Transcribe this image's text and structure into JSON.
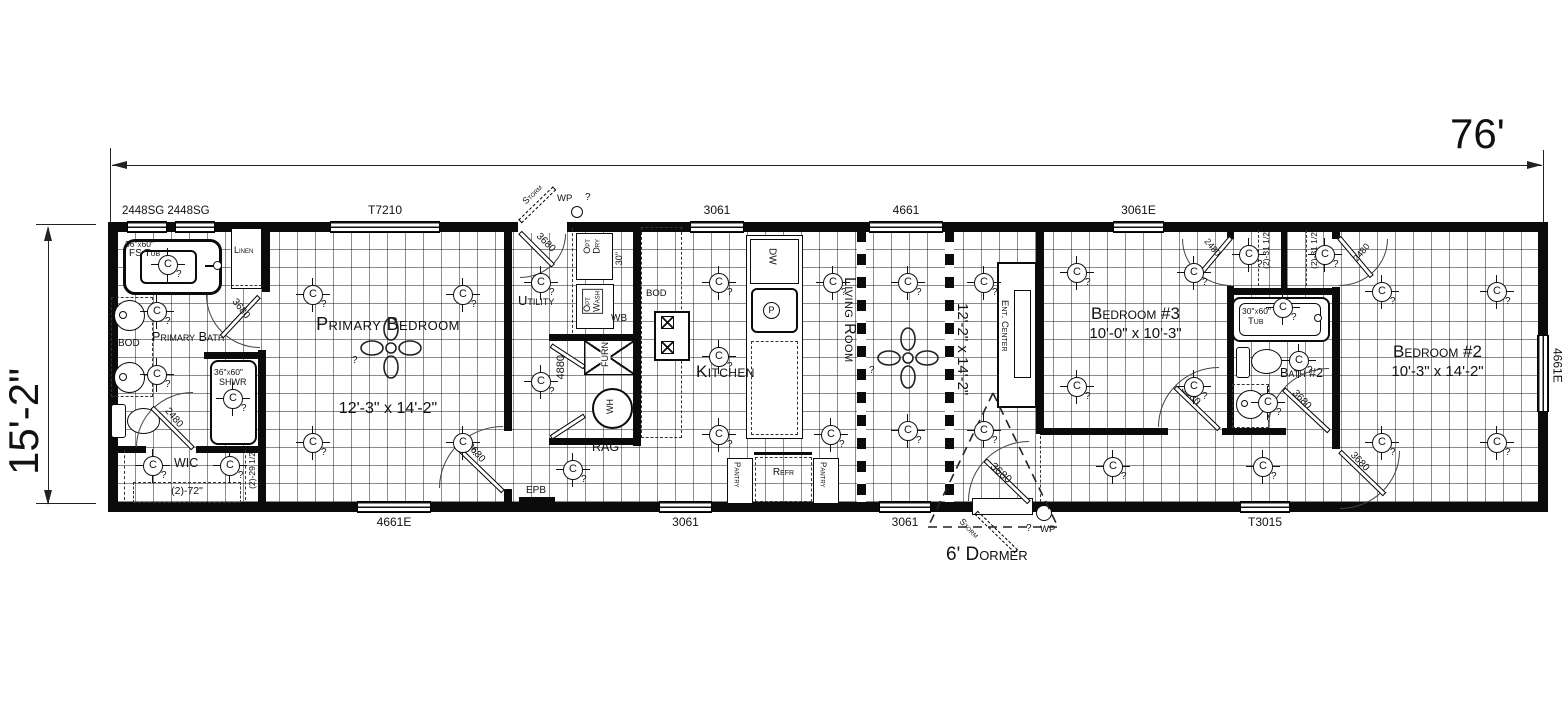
{
  "dimension_labels": {
    "overall_width": "76'",
    "overall_height": "15'-2\""
  },
  "window_labels": {
    "pair_2448sg": "2448SG 2448SG",
    "t7210": "T7210",
    "top_3061": "3061",
    "top_4661": "4661",
    "top_3061e": "3061E",
    "bottom_4661e": "4661E",
    "bottom_3061_kitchen": "3061",
    "bottom_3061_living": "3061",
    "bottom_t3015": "T3015",
    "right_4661e": "4661E"
  },
  "door_labels": {
    "d3680": "3680",
    "d2480": "2480",
    "d4880": "4880"
  },
  "rooms": {
    "primary_bath": {
      "name": "Primary Bath"
    },
    "wic": {
      "name": "WIC",
      "side_shelf": "(2)-29 1/2",
      "back_shelf": "(2)-72\""
    },
    "primary_bedroom": {
      "name": "Primary Bedroom",
      "size": "12'-3\" x 14'-2\""
    },
    "utility": {
      "name": "Utility"
    },
    "kitchen": {
      "name": "Kitchen"
    },
    "living_room": {
      "name": "Living Room",
      "size": "12'-2\" x 14'-2\""
    },
    "bedroom3": {
      "name": "Bedroom #3",
      "size": "10'-0\" x 10'-3\"",
      "closet_shelf": "(2)-31 1/2"
    },
    "bath2": {
      "name": "Bath #2",
      "tub_size": "30\"x60\"",
      "tub": "Tub"
    },
    "bedroom2": {
      "name": "Bedroom #2",
      "size": "10'-3\" x 14'-2\"",
      "closet_shelf": "(2)-31 1/2"
    }
  },
  "fixtures": {
    "linen": "Linen",
    "fs_tub_size": "36\"x60\"",
    "fs_tub": "FS Tub",
    "bod": "BOD",
    "shower_size": "36\"x60\"",
    "shower": "SHWR",
    "opt_dry": "Opt\nDry",
    "opt_wash": "Opt\nWash",
    "w30": "30\"",
    "wb": "WB",
    "furnace": "FURN",
    "water_heater": "WH",
    "rag": "RAG",
    "epb": "EPB",
    "dishwasher": "DW",
    "disposal": "P",
    "refrigerator": "Refr",
    "pantry": "Pantry",
    "ent_center": "Ent. Center"
  },
  "annotations": {
    "dormer": "6' Dormer",
    "storm": "Storm",
    "wp": "WP"
  },
  "symbols": {
    "light": "C",
    "unknown": "?"
  }
}
